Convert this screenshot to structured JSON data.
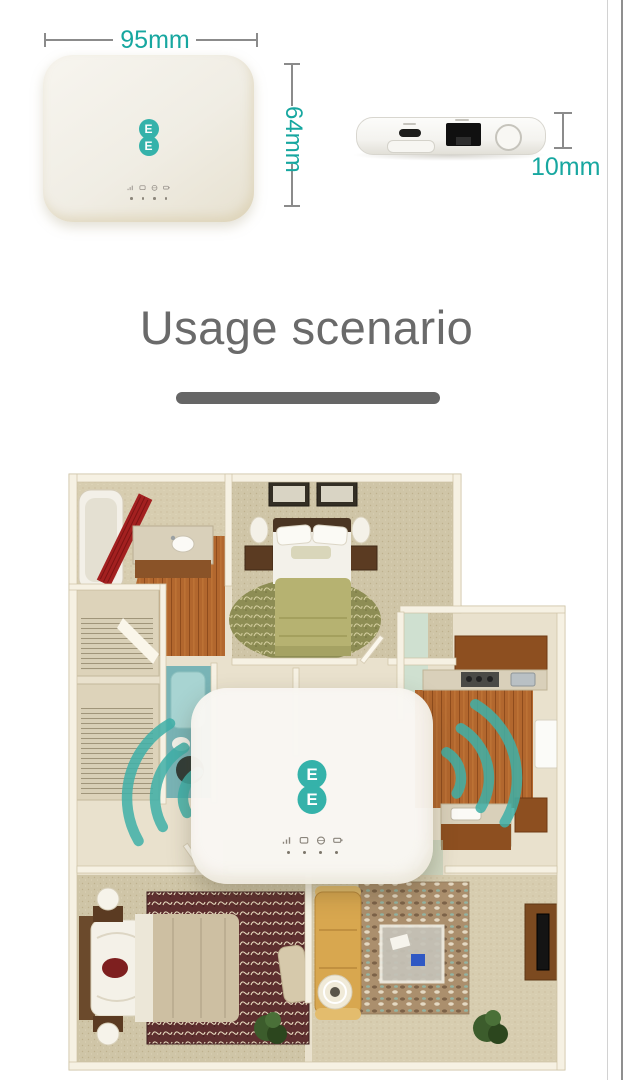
{
  "product": {
    "brand_letter": "E",
    "logo_color": "#35b2aa",
    "front_view": {
      "indicator_icons": [
        "signal-icon",
        "sms-icon",
        "wifi-icon",
        "battery-icon"
      ]
    },
    "side_view": {
      "ports": [
        "usb-c-port",
        "sim-slot",
        "lan-port",
        "power-button"
      ]
    },
    "dimensions": {
      "width": "95mm",
      "height": "64mm",
      "depth": "10mm",
      "text_color": "#17a7a0",
      "line_color": "#8b8b8b"
    }
  },
  "usage_section": {
    "title": "Usage scenario",
    "title_color": "#6a6a6a",
    "divider_color": "#666666"
  },
  "floorplan": {
    "wifi_color": "#3fb0a8",
    "router_brand_letter": "E",
    "router_indicator_icons": [
      "signal-icon",
      "sms-icon",
      "wifi-icon",
      "battery-icon"
    ]
  }
}
